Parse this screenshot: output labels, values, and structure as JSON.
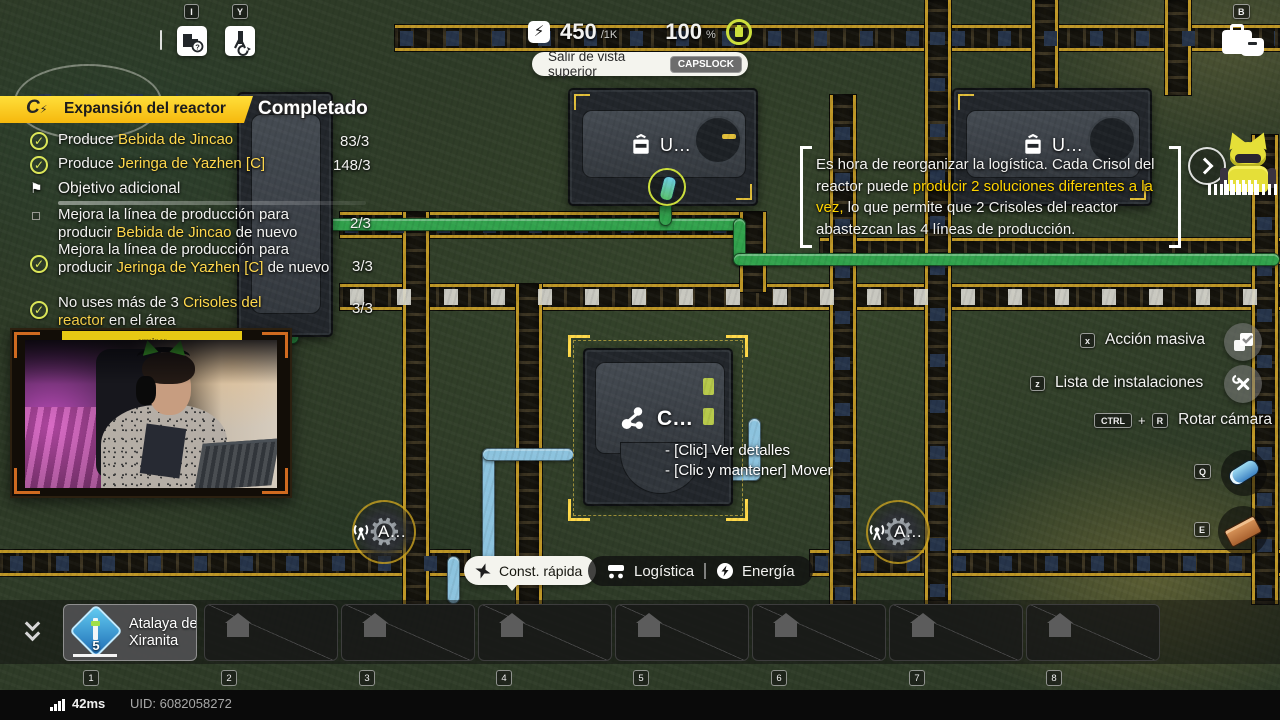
{
  "colors": {
    "accent_yellow": "#ffd400",
    "highlight_text": "#ffd84d",
    "check_green": "#dbe658",
    "pipe_green": "#31a24c",
    "pipe_blue": "#8cc3de",
    "belt_amber": "#bd9626"
  },
  "top_left_tools": {
    "inspect_key": "I",
    "tower_key": "Y"
  },
  "top_right": {
    "deposit_key": "B"
  },
  "resources": {
    "power": "450",
    "power_cap": "/1K",
    "charge": "100",
    "charge_unit": "%"
  },
  "view_banner": {
    "label": "Salir de vista superior",
    "key": "CAPSLOCK"
  },
  "quest": {
    "title": "Expansión del reactor",
    "status": "Completado",
    "additional_header": "Objetivo adicional",
    "flag_glyph": "⚑",
    "check_glyph": "✓",
    "objectives": [
      {
        "prefix": "Produce ",
        "highlight": "Bebida de Jincao",
        "suffix": "",
        "progress": "83/3"
      },
      {
        "prefix": "Produce ",
        "highlight": "Jeringa de Yazhen [C]",
        "suffix": "",
        "progress": "148/3"
      },
      {
        "prefix": "Mejora la línea de producción para producir ",
        "highlight": "Bebida de Jincao",
        "suffix": " de nuevo",
        "progress": "2/3"
      },
      {
        "prefix": "Mejora la línea de producción para producir ",
        "highlight": "Jeringa de Yazhen [C]",
        "suffix": " de nuevo",
        "progress": "3/3"
      },
      {
        "prefix": "No uses más de 3 ",
        "highlight": "Crisoles del reactor",
        "suffix": " en el área",
        "progress": "3/3"
      }
    ]
  },
  "guide_tooltip": {
    "prefix": "Es hora de reorganizar la logística. Cada Crisol del reactor puede ",
    "highlight": "producir 2 soluciones diferentes a la vez,",
    "suffix": " lo que permite que 2 Crisoles del reactor abastezcan las 4 líneas de producción."
  },
  "building_tooltip": {
    "title": "C…",
    "hint_details": "- [Clic] Ver detalles",
    "hint_move": "- [Clic y mantener] Mover"
  },
  "world_labels": {
    "machine_a": "U…",
    "machine_b": "U…",
    "tower_a": "A…",
    "tower_b": "A…"
  },
  "actions": {
    "mass_action": {
      "key": "x",
      "label": "Acción masiva"
    },
    "facility_list": {
      "key": "z",
      "label": "Lista de instalaciones"
    },
    "rotate_camera": {
      "key1": "CTRL",
      "plus": "+",
      "key2": "R",
      "label": "Rotar cámara"
    }
  },
  "quick_items": {
    "q_key": "Q",
    "e_key": "E"
  },
  "build_toolbar": {
    "quick_build": "Const. rápida",
    "logistics": "Logística",
    "energy": "Energía"
  },
  "hotbar": {
    "selected": {
      "label": "Atalaya de Xiranita",
      "count": "5"
    },
    "keys": [
      "1",
      "2",
      "3",
      "4",
      "5",
      "6",
      "7",
      "8"
    ]
  },
  "status_bar": {
    "ping": "42ms",
    "uid": "UID: 6082058272"
  },
  "webcam": {
    "banner": "erminer"
  },
  "icons": {
    "question_glyph": "?",
    "gear_glyph": "⚙",
    "bolt_glyph": "⚡"
  }
}
